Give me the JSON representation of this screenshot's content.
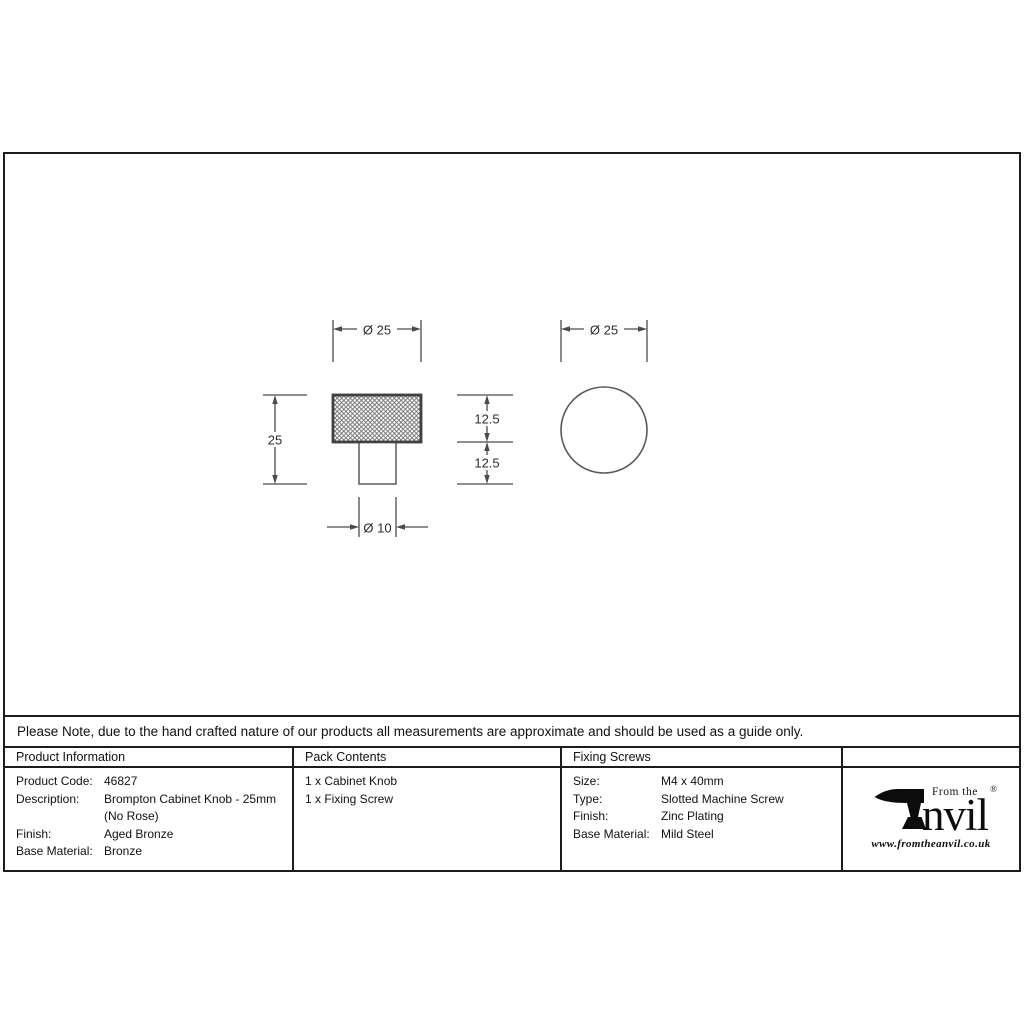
{
  "drawing": {
    "front_view": {
      "head_diameter": "Ø 25",
      "overall_height": "25",
      "head_height": "12.5",
      "stem_height": "12.5",
      "stem_diameter": "Ø 10"
    },
    "side_view": {
      "diameter": "Ø 25"
    }
  },
  "note": "Please Note, due to the hand crafted nature of our products all measurements are approximate and should be used as a guide only.",
  "table": {
    "product_information": {
      "header": "Product Information",
      "rows": [
        {
          "label": "Product Code:",
          "value": "46827"
        },
        {
          "label": "Description:",
          "value": "Brompton Cabinet Knob - 25mm"
        },
        {
          "label": "",
          "value": "(No Rose)"
        },
        {
          "label": "Finish:",
          "value": "Aged Bronze"
        },
        {
          "label": "Base Material:",
          "value": "Bronze"
        }
      ]
    },
    "pack_contents": {
      "header": "Pack Contents",
      "items": [
        "1 x Cabinet Knob",
        "1 x Fixing Screw"
      ]
    },
    "fixing_screws": {
      "header": "Fixing Screws",
      "rows": [
        {
          "label": "Size:",
          "value": "M4 x 40mm"
        },
        {
          "label": "Type:",
          "value": "Slotted Machine Screw"
        },
        {
          "label": "Finish:",
          "value": "Zinc Plating"
        },
        {
          "label": "Base Material:",
          "value": "Mild Steel"
        }
      ]
    }
  },
  "logo": {
    "tagline": "From the",
    "wordmark": "nvil",
    "registered": "®",
    "url": "www.fromtheanvil.co.uk"
  },
  "colors": {
    "border": "#1c1c1c",
    "drawing_line": "#5a5a5a",
    "dimension_line": "#4a4a4a",
    "knurl_border": "#414141",
    "text": "#111111"
  }
}
